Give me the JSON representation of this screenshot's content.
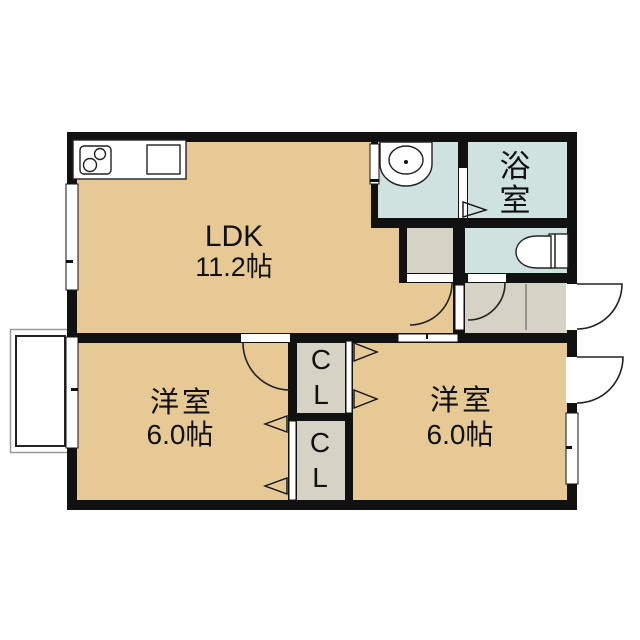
{
  "colors": {
    "floor_tan": "#e7c996",
    "floor_teal": "#cfe2e0",
    "floor_gray": "#d6d3c6",
    "wall": "#111111"
  },
  "rooms": {
    "ldk": {
      "label": "LDK",
      "size": "11.2帖"
    },
    "bathroom": {
      "char1": "浴",
      "char2": "室"
    },
    "western_left": {
      "label": "洋室",
      "size": "6.0帖"
    },
    "western_right": {
      "label": "洋室",
      "size": "6.0帖"
    },
    "closet_top": {
      "char1": "C",
      "char2": "L"
    },
    "closet_bottom": {
      "char1": "C",
      "char2": "L"
    }
  }
}
